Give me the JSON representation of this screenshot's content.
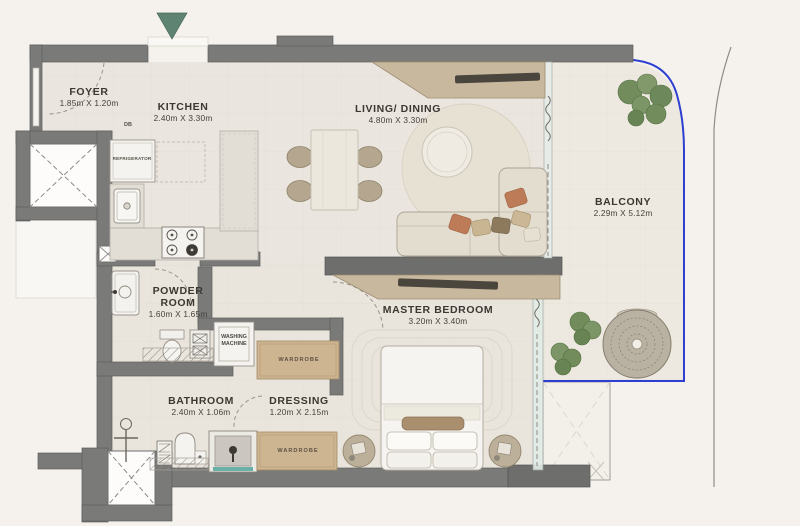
{
  "rooms": {
    "foyer": {
      "name": "FOYER",
      "dims": "1.85m X 1.20m"
    },
    "kitchen": {
      "name": "KITCHEN",
      "dims": "2.40m X 3.30m"
    },
    "living_dining": {
      "name": "LIVING/ DINING",
      "dims": "4.80m X 3.30m"
    },
    "balcony": {
      "name": "BALCONY",
      "dims": "2.29m X 5.12m"
    },
    "powder_room": {
      "name_line1": "POWDER",
      "name_line2": "ROOM",
      "dims": "1.60m X 1.65m"
    },
    "master_bedroom": {
      "name": "MASTER BEDROOM",
      "dims": "3.20m X 3.40m"
    },
    "bathroom": {
      "name": "BATHROOM",
      "dims": "2.40m X 1.06m"
    },
    "dressing": {
      "name": "DRESSING",
      "dims": "1.20m X 2.15m"
    }
  },
  "fixtures": {
    "refrigerator": "REFRIGERATOR",
    "distribution_board": "DB",
    "washing_machine_line1": "WASHING",
    "washing_machine_line2": "MACHINE",
    "wardrobe_top": "WARDROBE",
    "wardrobe_bottom": "WARDROBE"
  },
  "colors": {
    "wall": "#7a7a78",
    "balcony_boundary_blue": "#2d3fd0",
    "entry_arrow_green": "#5e8372",
    "wood": "#cdb592",
    "accent_teal": "#54a69c"
  }
}
